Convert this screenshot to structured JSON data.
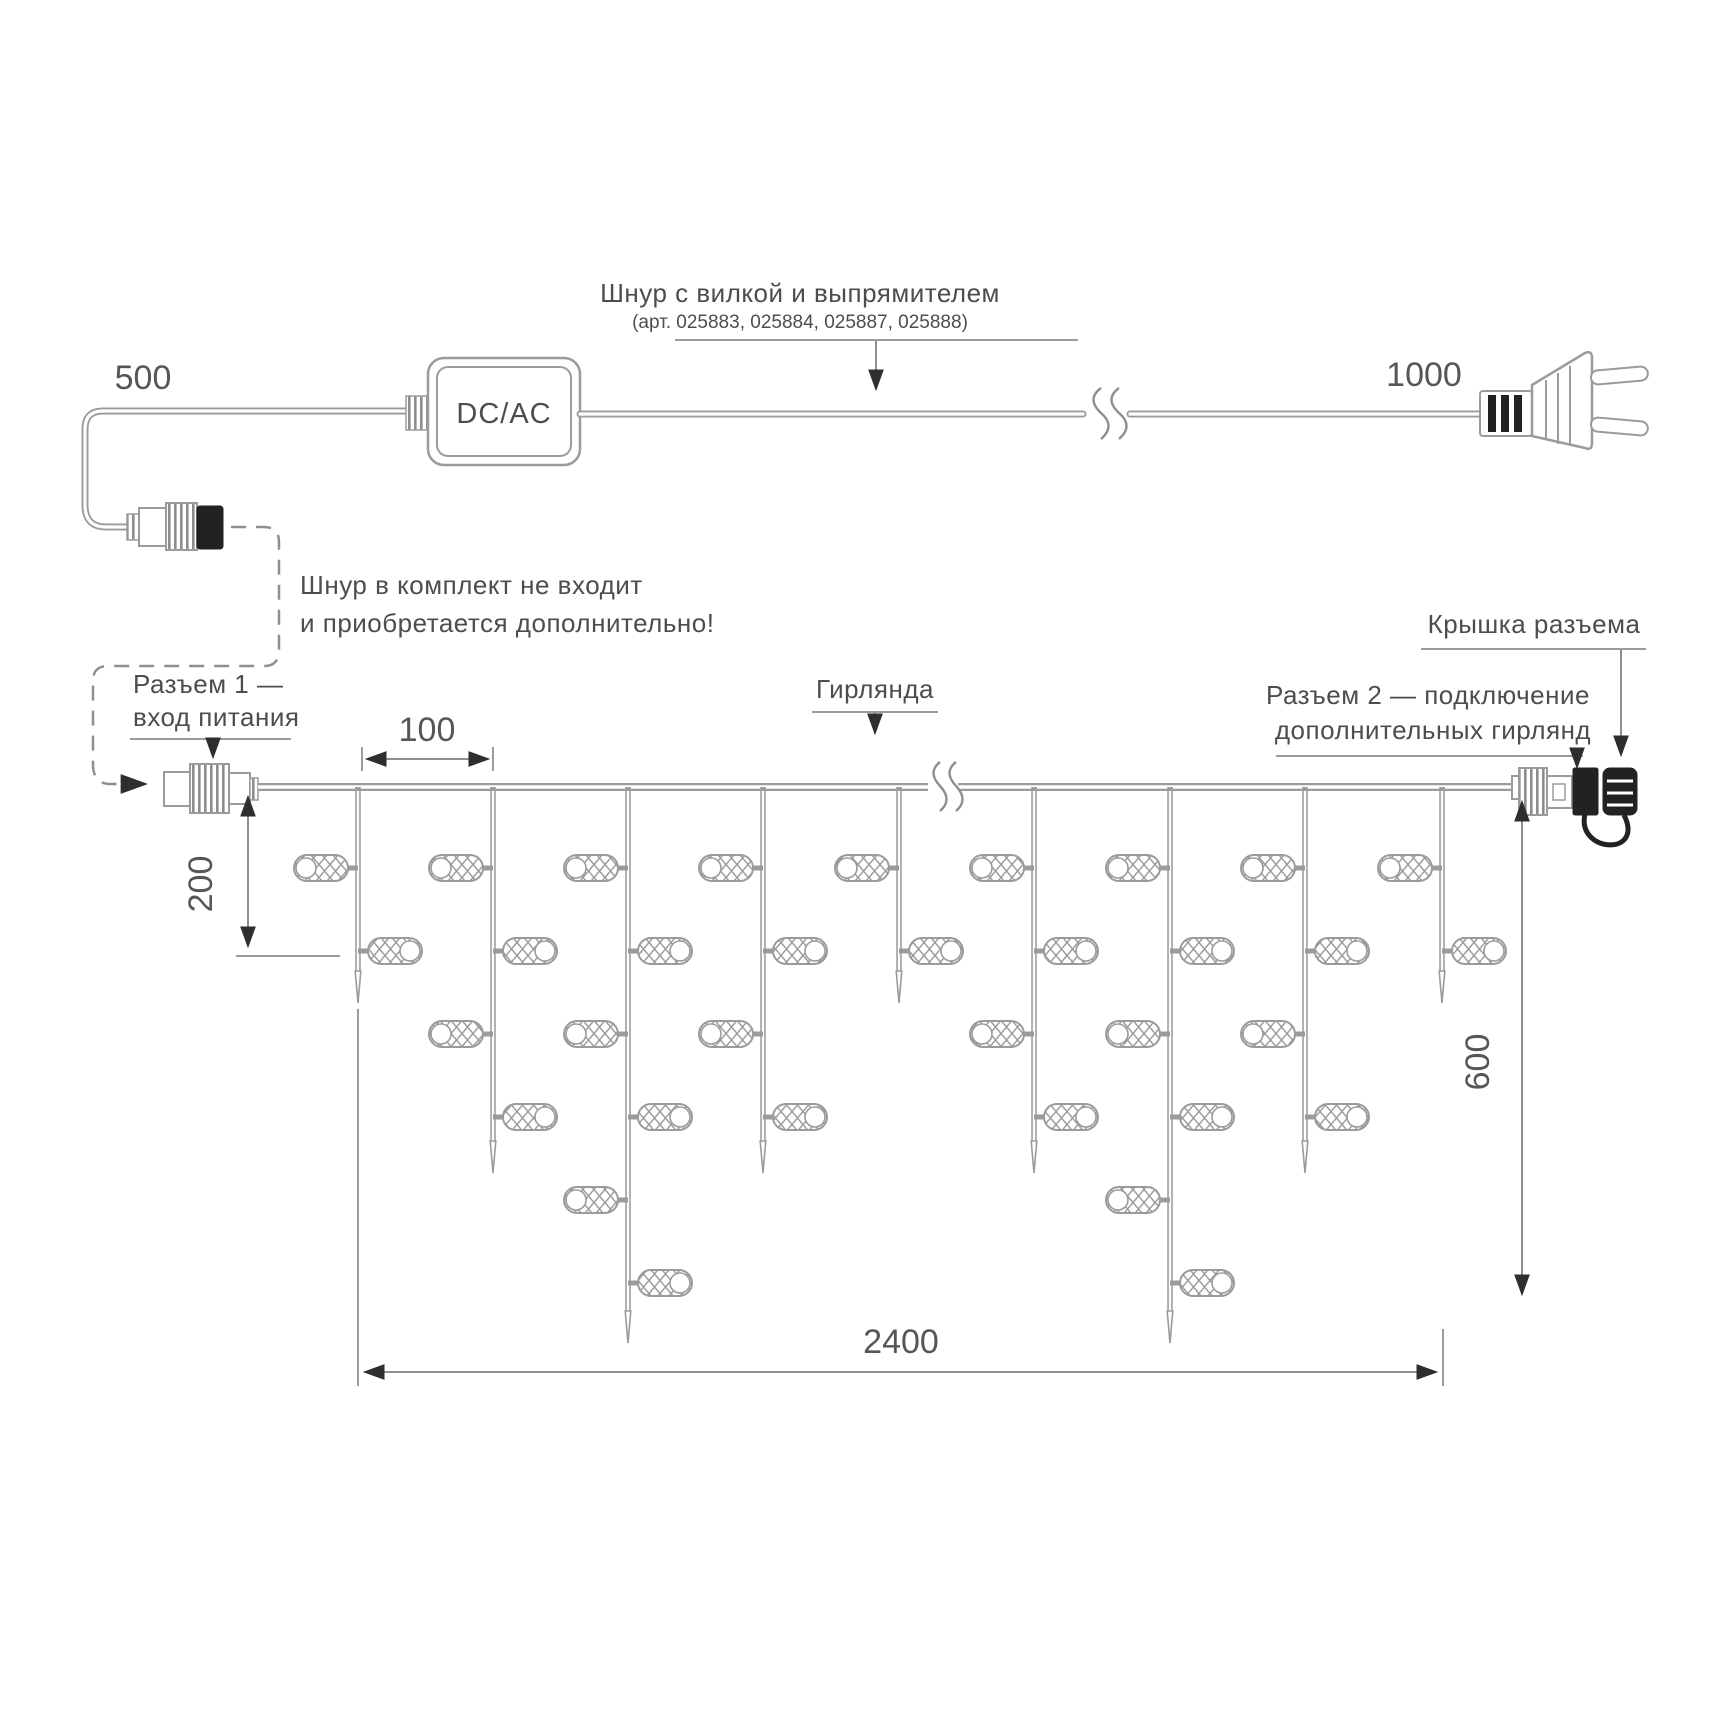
{
  "colors": {
    "line": "#9b9b9b",
    "text": "#4d4d4d",
    "arrow": "#2e2e2e",
    "dark_parts": "#222222",
    "background": "#ffffff"
  },
  "top_section": {
    "cord_label": "Шнур с вилкой и выпрямителем",
    "cord_articles": "(арт. 025883, 025884, 025887, 025888)",
    "dim_cord_left": "500",
    "dim_cord_right": "1000",
    "converter_label": "DC/AC",
    "note_line1": "Шнур в комплект не входит",
    "note_line2": "и приобретается дополнительно!"
  },
  "garland_section": {
    "connector1_line1": "Разъем 1 —",
    "connector1_line2": "вход питания",
    "garland_label": "Гирлянда",
    "connector2_line1": "Разъем 2 — подключение",
    "connector2_line2": "дополнительных гирлянд",
    "cap_label": "Крышка разъема",
    "dim_led_spacing": "100",
    "dim_first_drop": "200",
    "dim_height": "600",
    "dim_length": "2400"
  },
  "drops_spec": {
    "start_y": 787,
    "xs": [
      358,
      493,
      628,
      763,
      899,
      1034,
      1170,
      1305,
      1442
    ],
    "led_counts": [
      2,
      4,
      6,
      4,
      2,
      4,
      6,
      4,
      2
    ],
    "tip_by_count": {
      "2": 1003,
      "4": 1173,
      "6": 1343
    },
    "level_start": 868,
    "level_step": 83,
    "led_w": 54,
    "led_h": 26,
    "stub": 10,
    "line_color": "#9b9b9b"
  }
}
